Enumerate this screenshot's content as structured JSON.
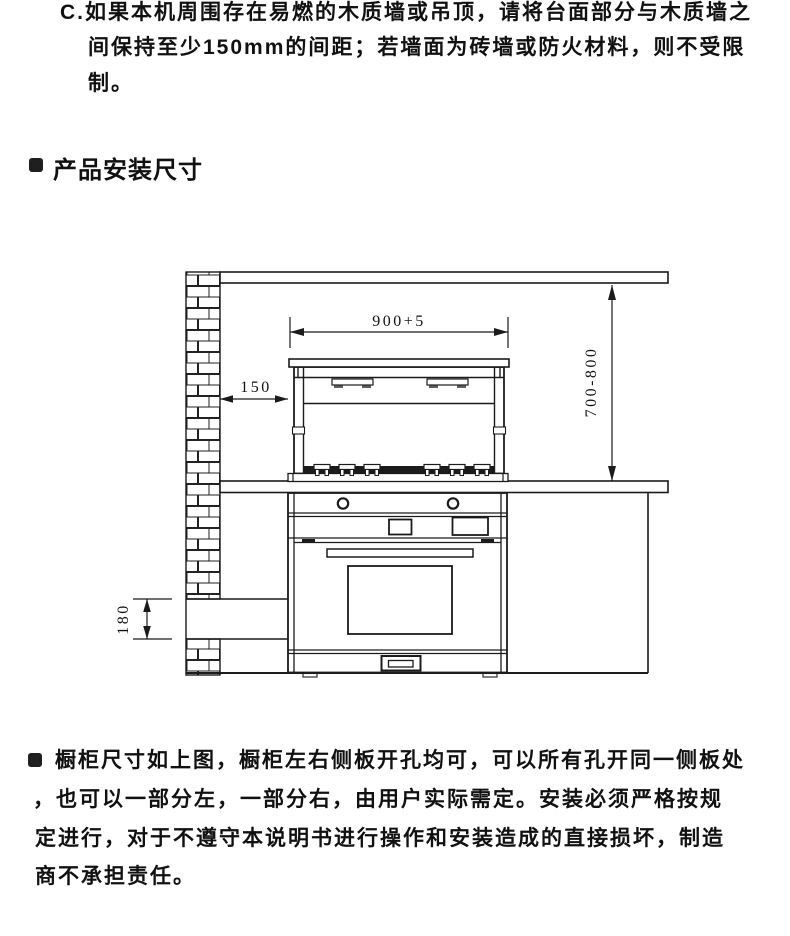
{
  "colors": {
    "ink": "#1b1b1b",
    "paper": "#ffffff"
  },
  "top_note": {
    "lines": [
      "C.如果本机周围存在易燃的木质墙或吊顶，请将台面部分与木质墙之",
      "间保持至少150mm的间距；若墙面为砖墙或防火材料，则不受限",
      "制。"
    ]
  },
  "section_header": {
    "title": "产品安装尺寸"
  },
  "diagram": {
    "type": "installation-dimension-drawing",
    "dimensions": {
      "cutout_width": "900+5",
      "wall_clearance": "150",
      "hood_height_range": "700-800",
      "outlet_height": "180"
    }
  },
  "bottom_note": {
    "lines": [
      "橱柜尺寸如上图，橱柜左右侧板开孔均可，可以所有孔开同一侧板处",
      "，也可以一部分左，一部分右，由用户实际需定。安装必须严格按规",
      "定进行，对于不遵守本说明书进行操作和安装造成的直接损坏，制造",
      "商不承担责任。"
    ]
  }
}
